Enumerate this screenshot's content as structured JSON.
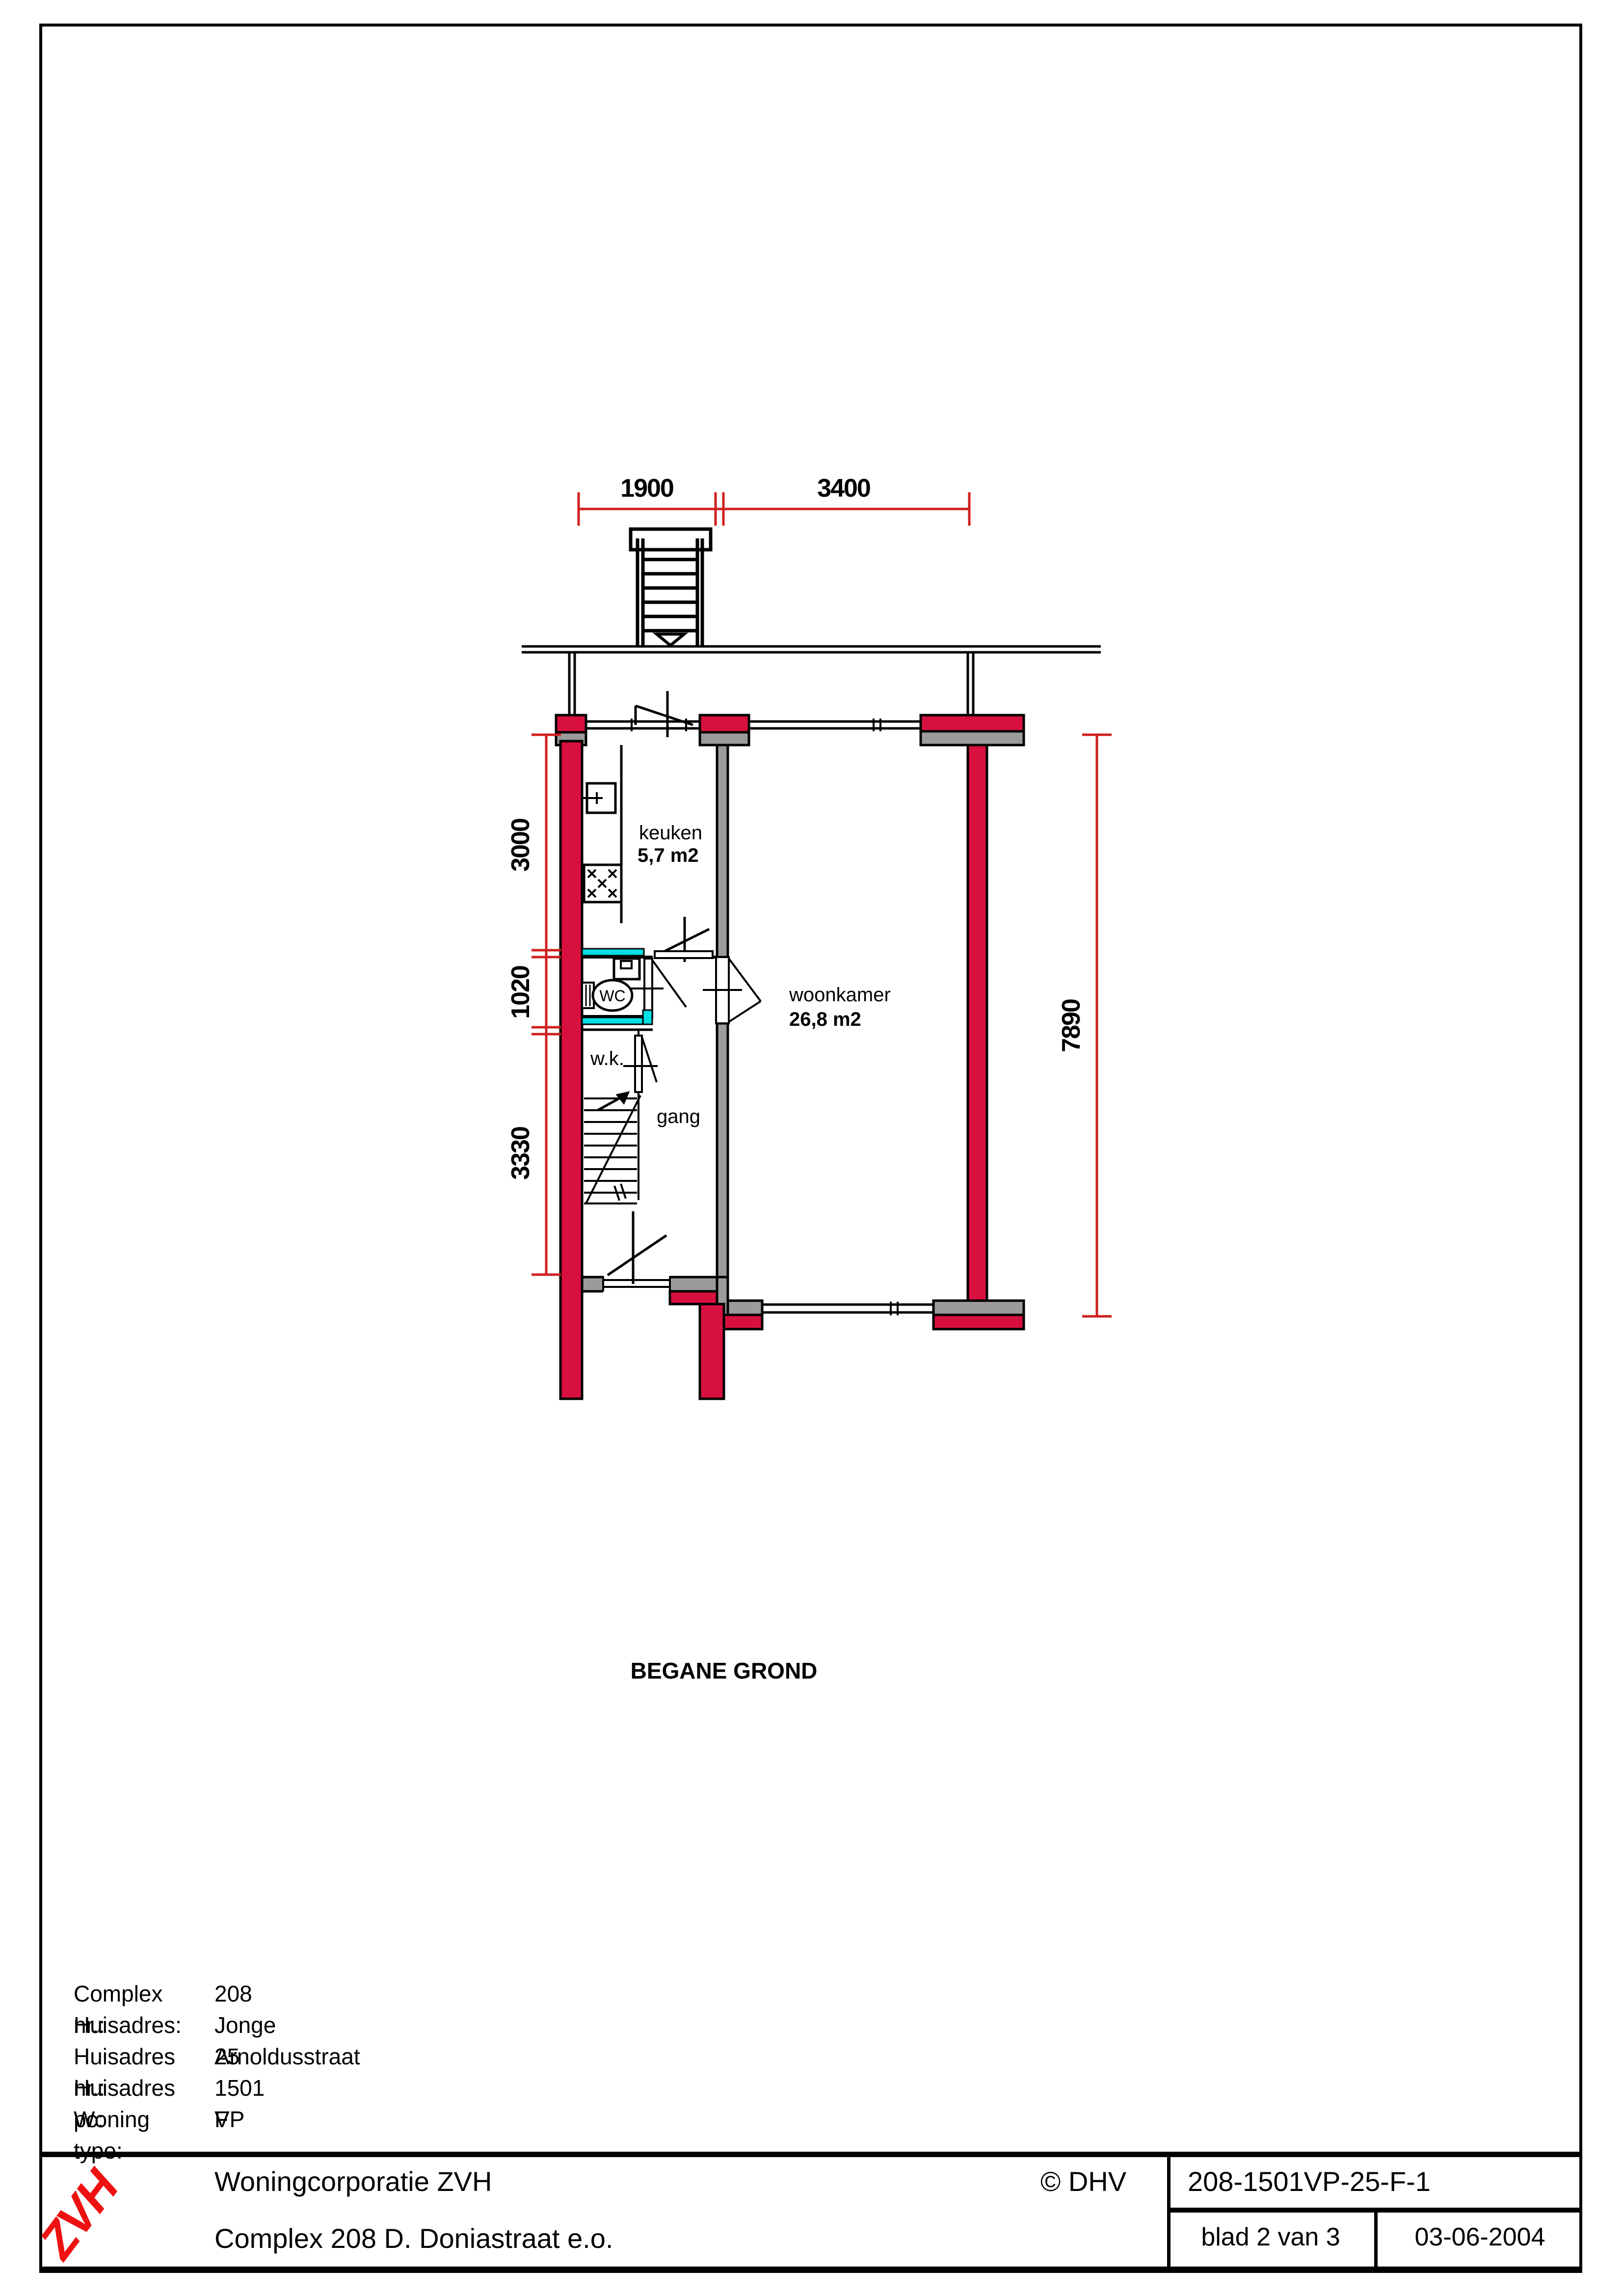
{
  "colors": {
    "wall-red": "#d8103f",
    "dim-red": "#cf1f1f",
    "cyan": "#00dfe4",
    "gray": "#9b9b9b",
    "logo-red": "#ee1111"
  },
  "plan": {
    "floor_title": "BEGANE GROND",
    "rooms": {
      "keuken": {
        "name": "keuken",
        "area": "5,7 m2"
      },
      "woonkamer": {
        "name": "woonkamer",
        "area": "26,8 m2"
      },
      "gang": {
        "name": "gang"
      },
      "wk": {
        "name": "w.k."
      },
      "wc": {
        "name": "WC"
      }
    },
    "dimensions": {
      "top": [
        "1900",
        "3400"
      ],
      "left": [
        "3000",
        "1020",
        "3330"
      ],
      "right": [
        "7890"
      ]
    }
  },
  "info": {
    "rows": [
      {
        "label": "Complex nr.:",
        "value": "208"
      },
      {
        "label": "Huisadres:",
        "value": "Jonge Arnoldusstraat"
      },
      {
        "label": "Huisadres nr.:",
        "value": "25"
      },
      {
        "label": "Huisadres pc:",
        "value": "1501 VP"
      },
      {
        "label": "Woning type:",
        "value": "F"
      }
    ]
  },
  "footer": {
    "logo": "ZVH",
    "company": "Woningcorporatie ZVH",
    "project": "Complex 208 D. Doniastraat e.o.",
    "copyright": "© DHV",
    "drawing_code": "208-1501VP-25-F-1",
    "sheet": "blad 2 van 3",
    "date": "03-06-2004"
  }
}
